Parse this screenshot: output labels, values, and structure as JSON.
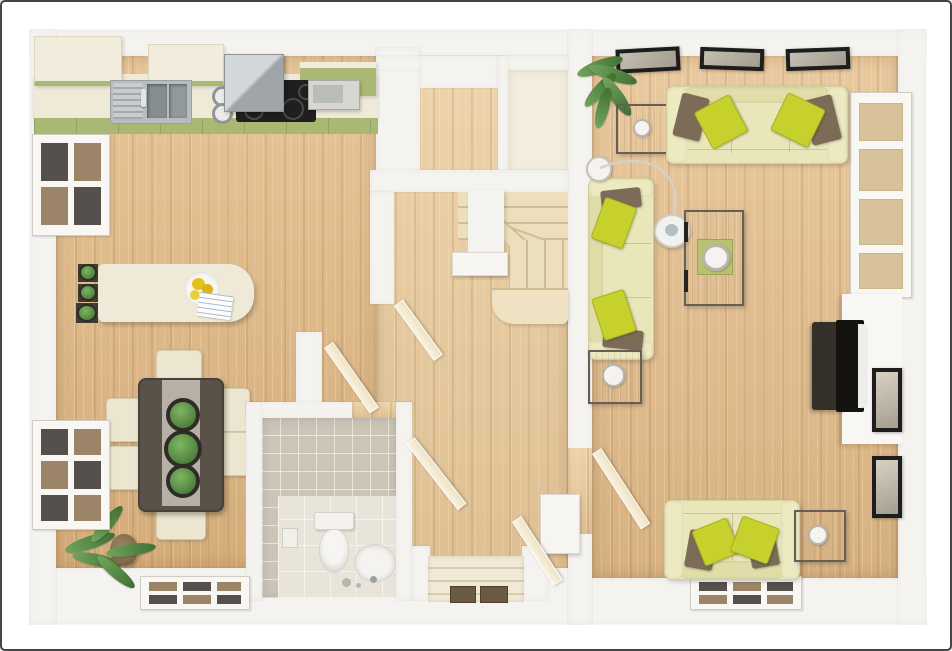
{
  "title": "3D top-down floor plan — ground floor with kitchen-diner, hallway with winder staircase and WC, and living room",
  "palette": {
    "frame_border": "#454545",
    "wall": "#f5f3ef",
    "wood_kitchen": "#ddb685",
    "wood_hall": "#e7cba0",
    "wood_living": "#e0bc8e",
    "cabinet_cream": "#f1ecdb",
    "counter_cream": "#efe9d8",
    "olive_accent": "#a9b873",
    "stainless": "#b7bcbe",
    "hob_black": "#1f1f1f",
    "tile_wc": "#cbc4b7",
    "wc_floor": "#e9e4da",
    "stair_tread": "#ebdfbe",
    "door_leaf": "#eee3c4",
    "sofa_cream": "#e9e6ba",
    "pillow_green": "#c6d12e",
    "pillow_brown": "#7b6b57",
    "table_grey": "#8a8279",
    "table_dark": "#5a5248",
    "plant_green": "#5d8f4a",
    "mat_brown": "#6b5942",
    "glass_dark": "#55504b",
    "glass_tan": "#9c8468",
    "window_tan": "#d8c29a"
  },
  "floorplan": {
    "view": "top-down 3D architectural render, no text labels",
    "rooms": [
      {
        "name": "kitchen-diner",
        "position": "left",
        "features": [
          "fitted counter with stainless sink and drainer",
          "black hob with extractor hood",
          "microwave",
          "cream wall cabinets with olive-green accents",
          "breakfast island with fruit plate, papers and three small potted plants",
          "dark dining table with grey runner, three planters and six cream chairs",
          "two windows on left wall",
          "window in bottom wall",
          "potted palm in bottom-left corner"
        ]
      },
      {
        "name": "hallway",
        "position": "center",
        "features": [
          "winder staircase with cream treads and white spine wall",
          "storage cupboard at top",
          "cloakroom WC with beige tiles, toilet, pedestal basin and toilet-roll holder",
          "front door at bottom with steps and two brown mats",
          "white console/radiator",
          "five open cream doors"
        ]
      },
      {
        "name": "living-room",
        "position": "right",
        "features": [
          "three-seat cream sofa with green and brown cushions",
          "two-seat sofa against dividing wall",
          "loveseat against bottom wall",
          "grey-brown coffee table with green tray and white bowl",
          "square side tables with cup and bowls",
          "arc floor lamp",
          "TV on white media wall",
          "three pictures on top wall",
          "two pictures on right wall",
          "tall window on right wall",
          "window in bottom wall",
          "potted palm in top-left corner"
        ]
      }
    ]
  }
}
